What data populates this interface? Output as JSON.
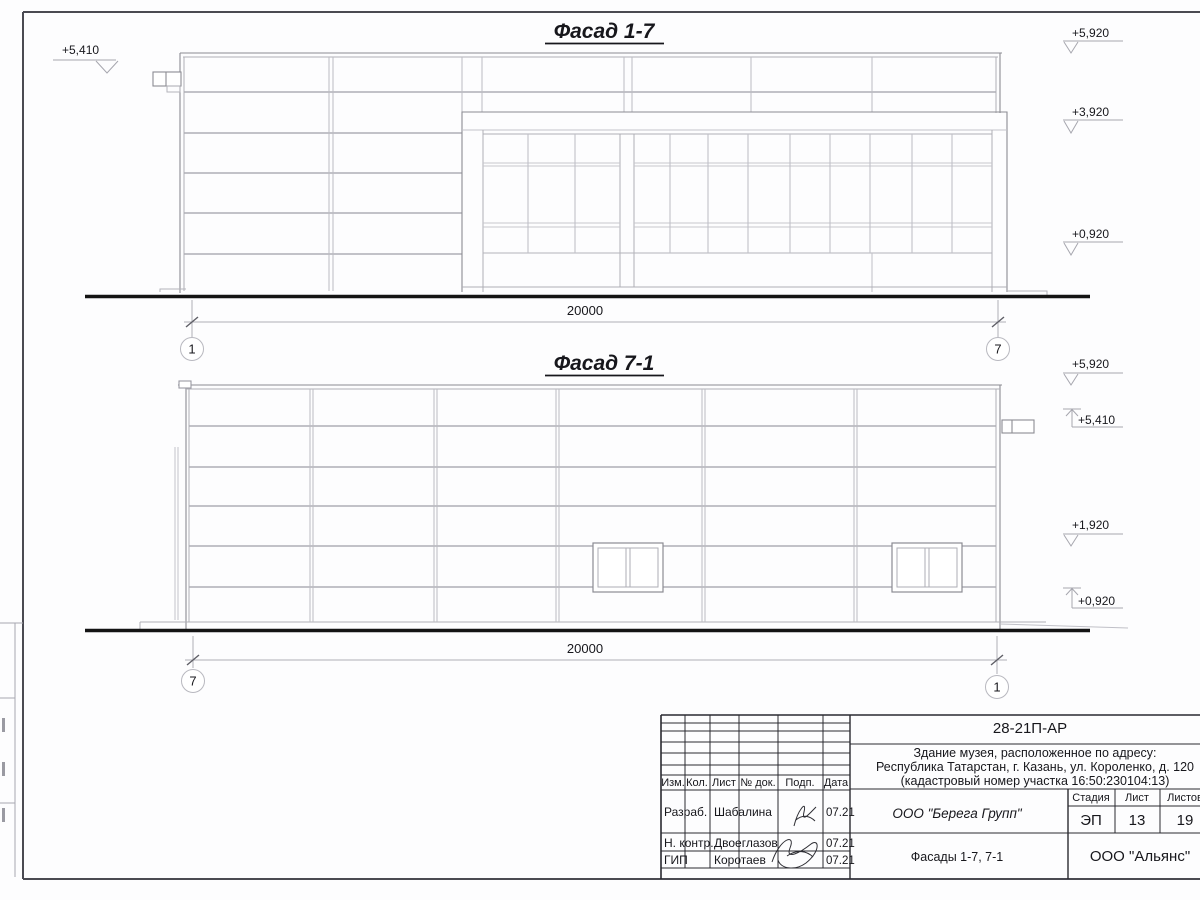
{
  "colors": {
    "ink": "#17171c",
    "line_light": "#b0b0b7",
    "ground": "#141414"
  },
  "drawing": {
    "facades": [
      {
        "title": "Фасад 1-7",
        "dim": "20000",
        "grid_left": "1",
        "grid_right": "7",
        "level_left": "+5,410",
        "levels_right": [
          "+5,920",
          "+3,920",
          "+0,920"
        ]
      },
      {
        "title": "Фасад 7-1",
        "dim": "20000",
        "grid_left": "7",
        "grid_right": "1",
        "levels_right": [
          "+5,920",
          "+5,410",
          "+1,920",
          "+0,920"
        ]
      }
    ],
    "titleblock": {
      "doc_number": "28-21П-АР",
      "address_line1": "Здание музея, расположенное по адресу:",
      "address_line2": "Республика Татарстан, г. Казань, ул. Короленко, д. 120",
      "address_line3": "(кадастровый номер участка 16:50:230104:13)",
      "col_izm": "Изм.",
      "col_kol": "Кол.",
      "col_list": "Лист",
      "col_ndok": "№ док.",
      "col_podp": "Подп.",
      "col_data": "Дата",
      "row1_role": "Разраб.",
      "row1_name": "Шабалина",
      "row1_date": "07.21",
      "row2_role": "Н. контр.",
      "row2_name": "Двоеглазов",
      "row2_date": "07.21",
      "row3_role": "ГИП",
      "row3_name": "Коротаев",
      "row3_date": "07.21",
      "company": "ООО \"Берега Групп\"",
      "sheet_title": "Фасады 1-7, 7-1",
      "stage_label": "Стадия",
      "list_label": "Лист",
      "listov_label": "Листов",
      "stage": "ЭП",
      "list": "13",
      "listov": "19",
      "org": "ООО \"Альянс\""
    }
  }
}
